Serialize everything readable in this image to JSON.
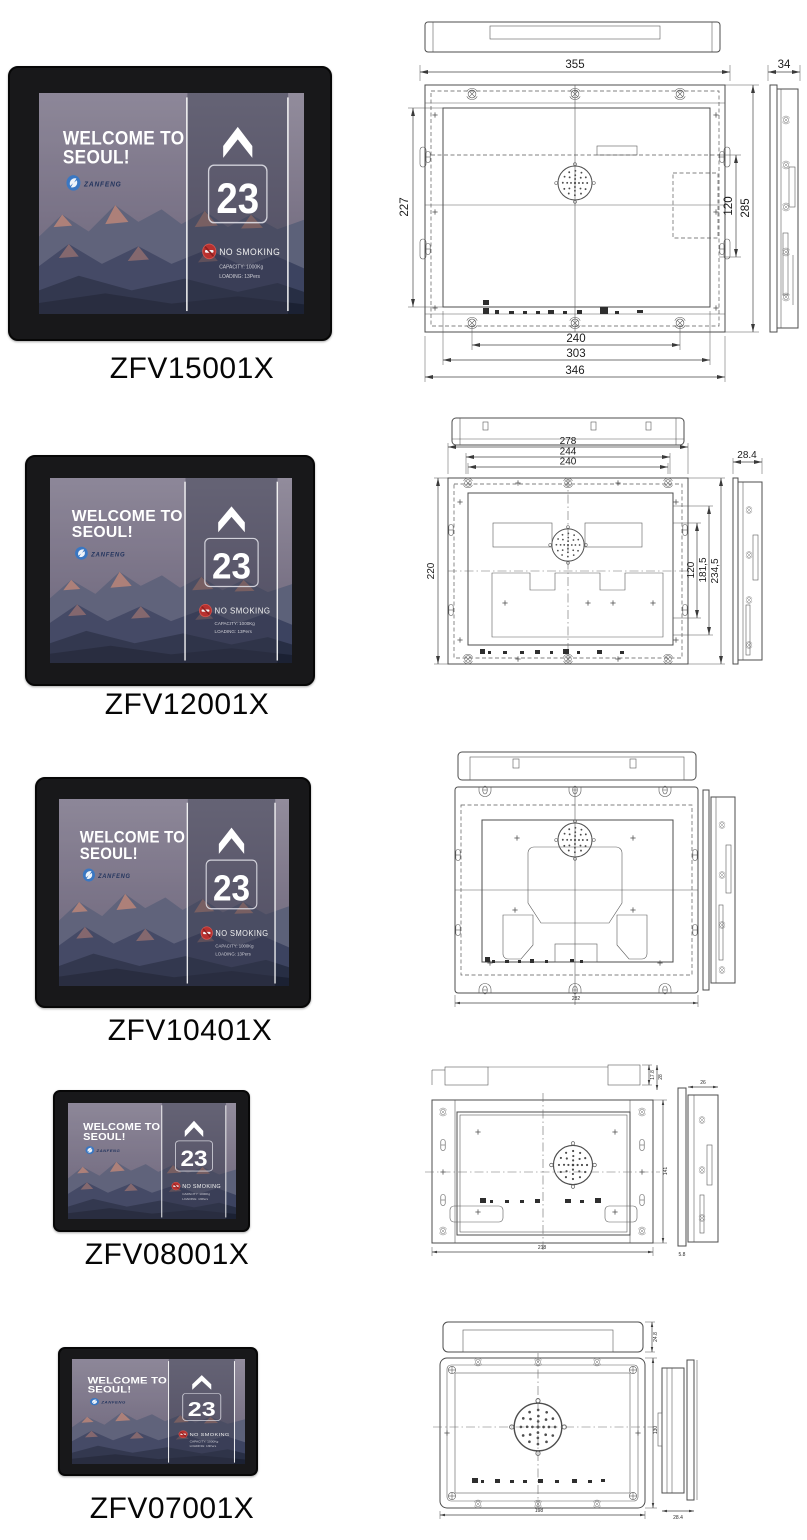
{
  "page": {
    "background": "#ffffff"
  },
  "screen": {
    "welcome_line1": "WELCOME TO",
    "welcome_line2": "SEOUL!",
    "brand": "ZANFENG",
    "floor": "23",
    "no_smoking": "NO SMOKING",
    "capacity": "CAPACITY: 1000Kg",
    "loading": "LOADING: 13Pers",
    "accent_red": "#b8312f",
    "logo_blue": "#3a77c2"
  },
  "products": [
    {
      "model": "ZFV15001X",
      "dims": {
        "top_width": "355",
        "depth": "34",
        "left_height": "227",
        "right_inner": "120",
        "right_outer": "285",
        "bottom_a": "240",
        "bottom_b": "303",
        "bottom_c": "346"
      }
    },
    {
      "model": "ZFV12001X",
      "dims": {
        "top_a": "278",
        "top_b": "244",
        "top_c": "240",
        "depth": "28.4",
        "left_height": "220",
        "right_a": "120",
        "right_b": "181,5",
        "right_c": "234,5"
      }
    },
    {
      "model": "ZFV10401X",
      "dims": {
        "bottom_width": "282"
      }
    },
    {
      "model": "ZFV08001X",
      "dims": {
        "top_a": "17.8",
        "top_b": "28",
        "bottom_width": "218",
        "right_height": "141",
        "side_top": "26",
        "side_bottom": "5.8"
      }
    },
    {
      "model": "ZFV07001X",
      "dims": {
        "top_depth": "24.8",
        "bottom_width": "198",
        "right_height": "130",
        "side_depth": "28.4"
      }
    }
  ]
}
